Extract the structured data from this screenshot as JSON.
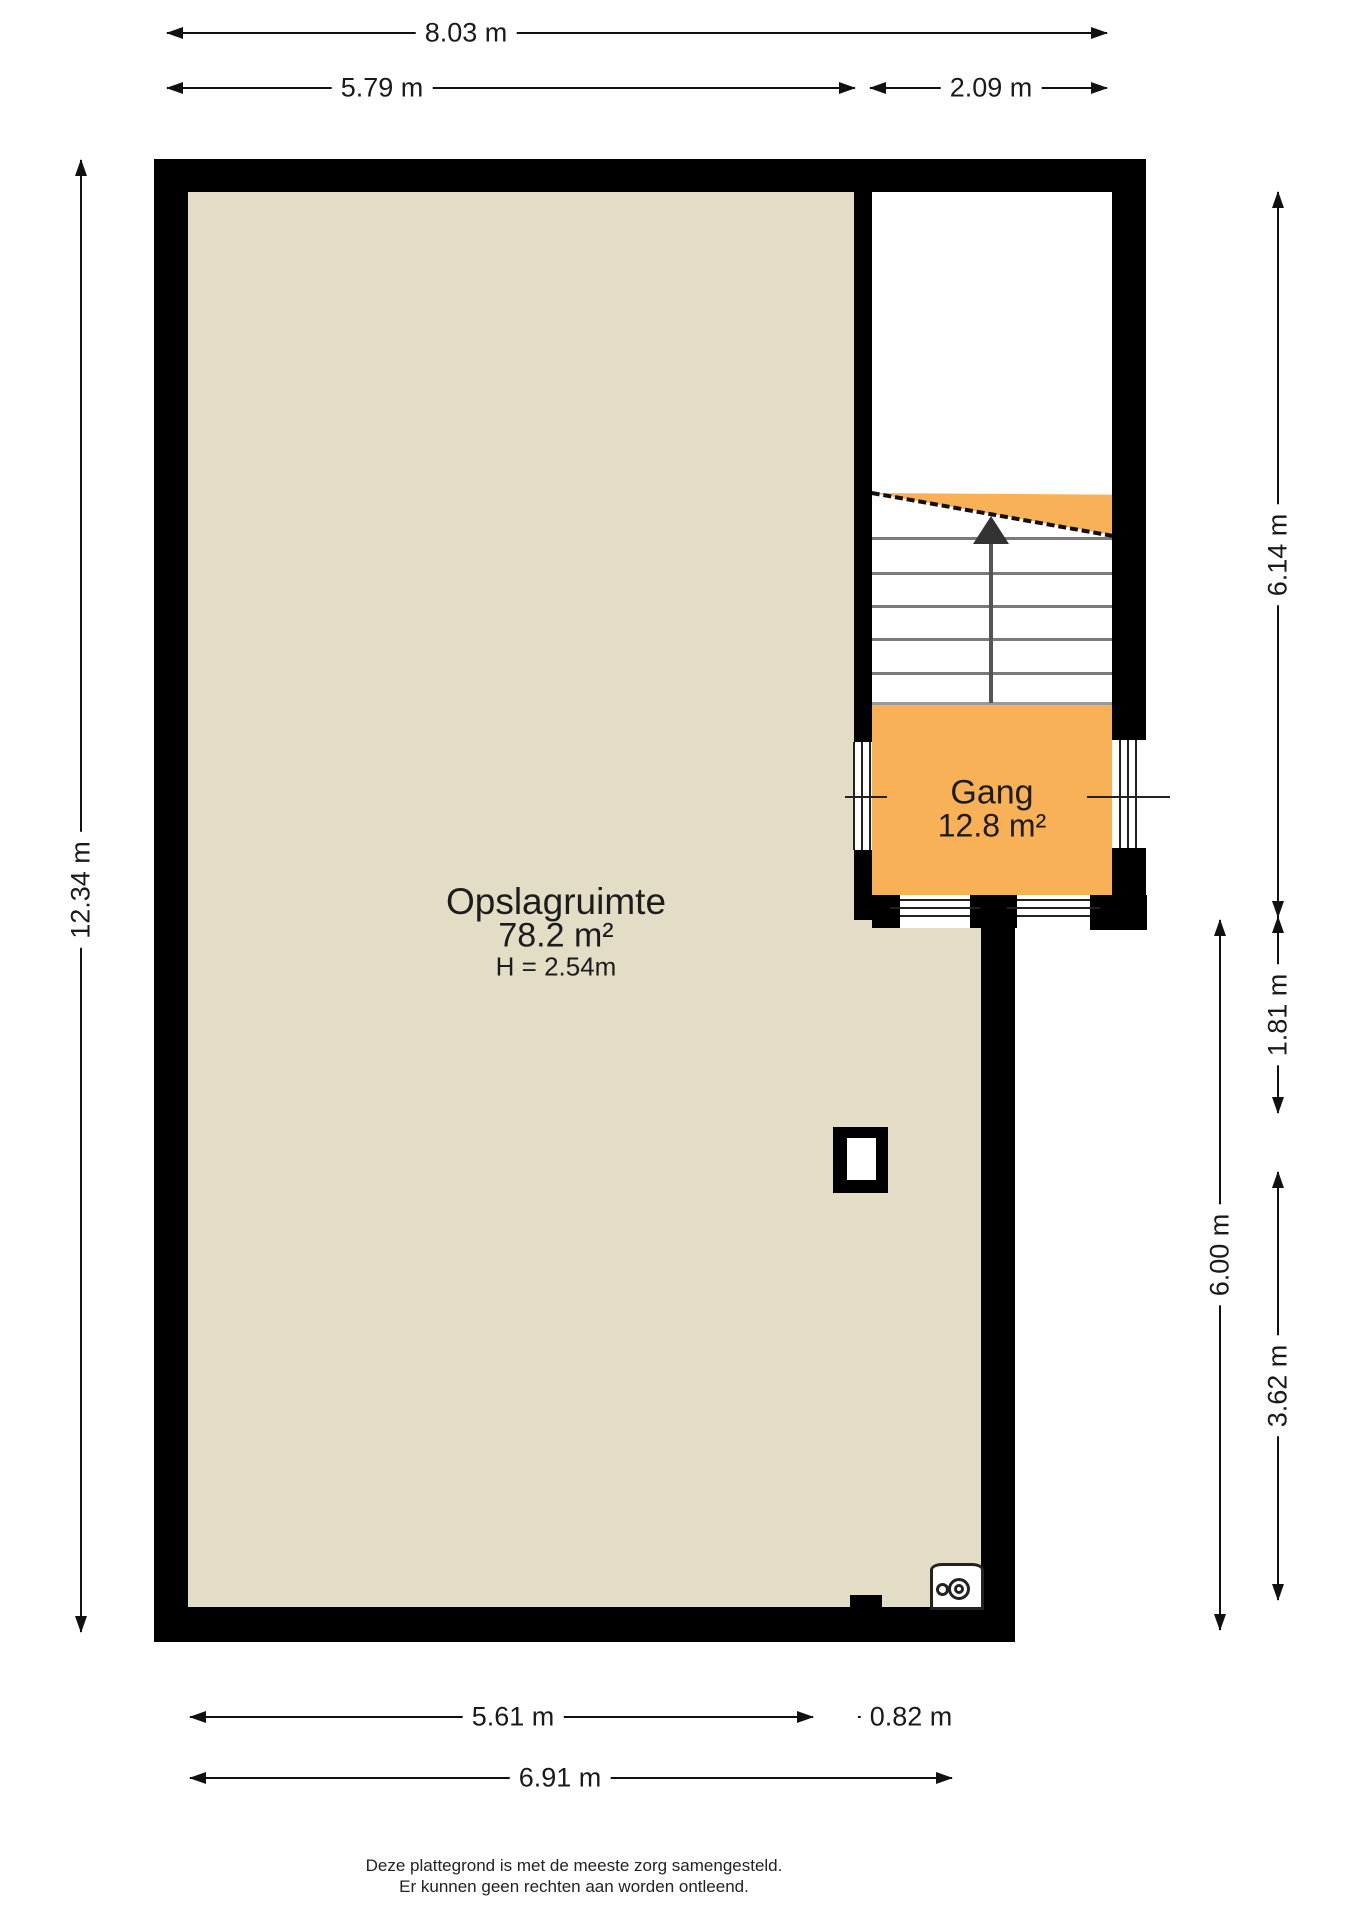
{
  "rooms": {
    "opslagruimte": {
      "name": "Opslagruimte",
      "area": "78.2 m²",
      "ceiling_height": "H = 2.54m"
    },
    "gang": {
      "name": "Gang",
      "area": "12.8 m²"
    }
  },
  "dimensions": {
    "top_total": "8.03 m",
    "top_left": "5.79 m",
    "top_right": "2.09 m",
    "left_total": "12.34 m",
    "right_upper": "6.14 m",
    "right_mid": "1.81 m",
    "right_inner": "6.00 m",
    "right_lower": "3.62 m",
    "bottom_left": "5.61 m",
    "bottom_right": "0.82 m",
    "bottom_total": "6.91 m"
  },
  "icons": {
    "stairs_direction": "up-arrow",
    "boiler": "boiler-unit"
  },
  "colors": {
    "wall": "#000000",
    "floor_main": "#e3ddc5",
    "floor_gang": "#f8b156",
    "dimension_line": "#111111"
  },
  "footer": {
    "line1": "Deze plattegrond is met de meeste zorg samengesteld.",
    "line2": "Er kunnen geen rechten aan worden ontleend."
  }
}
